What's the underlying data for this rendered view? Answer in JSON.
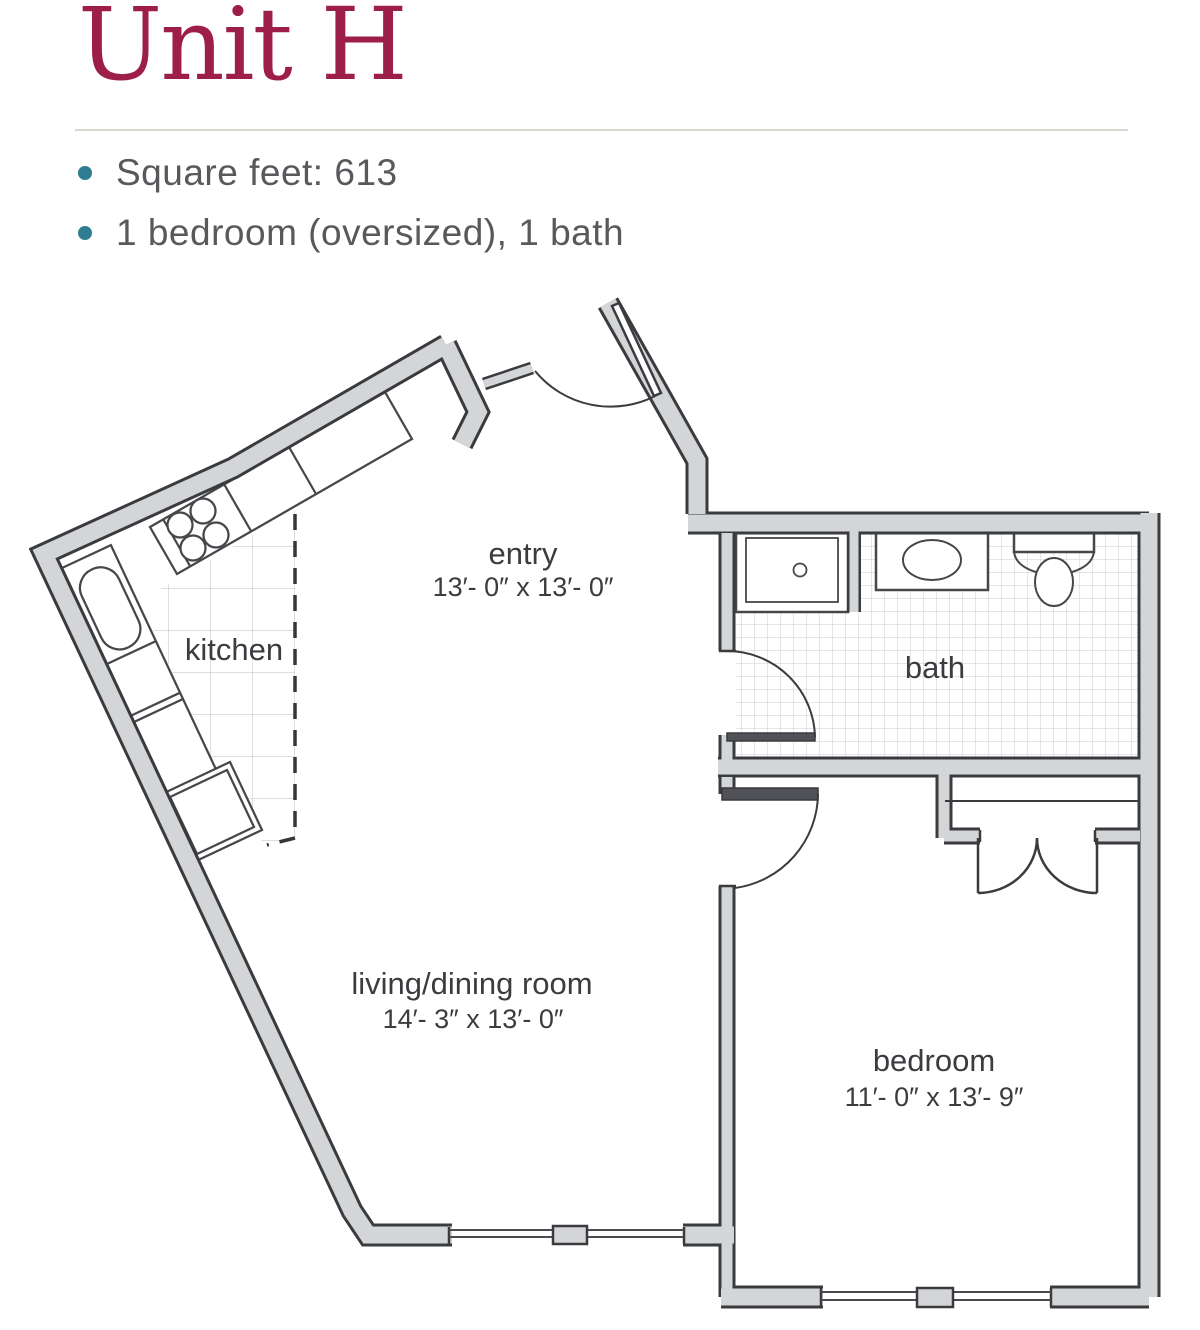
{
  "header": {
    "title": "Unit H",
    "bullets": [
      "Square feet: 613",
      "1 bedroom (oversized), 1 bath"
    ]
  },
  "colors": {
    "title_accent": "#9e1e4a",
    "bullet_dot_teal": "#2f7d92",
    "body_text_gray": "#58595c",
    "wall_fill": "#d4d5d7",
    "wall_outline": "#3a3b3e",
    "tile_line": "#c9cccf"
  },
  "floorplan": {
    "entry": {
      "name": "entry",
      "dims": "13′- 0″ x 13′- 0″"
    },
    "kitchen": {
      "name": "kitchen"
    },
    "bath": {
      "name": "bath"
    },
    "living": {
      "name": "living/dining room",
      "dims": "14′- 3″ x 13′- 0″"
    },
    "bedroom": {
      "name": "bedroom",
      "dims": "11′- 0″ x 13′- 9″"
    }
  }
}
